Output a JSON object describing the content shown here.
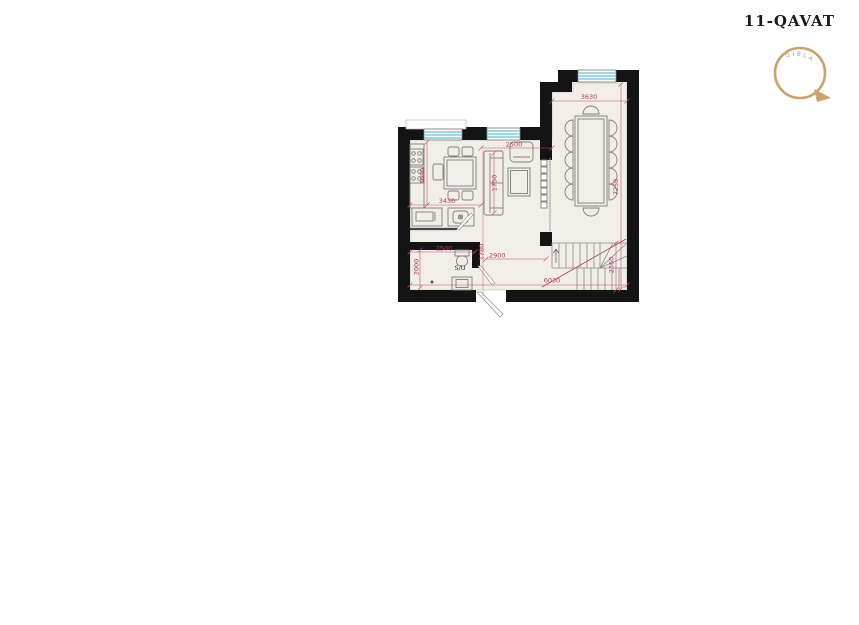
{
  "page": {
    "title": "11-QAVAT"
  },
  "compass": {
    "label": "QIBLA"
  },
  "plan": {
    "rooms": {
      "bathroom_label": "S/U"
    },
    "dimensions": {
      "conference_width": "3630",
      "conference_height": "7250",
      "living_width": "2500",
      "sofa_length": "1750",
      "kitchen_height": "3050",
      "kitchen_width": "3430",
      "su_width": "2500",
      "su_height": "2000",
      "hall_height": "1780",
      "hall_width": "2900",
      "bottom_width": "6030",
      "stairs_height": "2360"
    },
    "colors": {
      "wall": "#141414",
      "floor": "#f1eee8",
      "window_stripe": "#7ec8e3",
      "dimension": "#b83a52",
      "furniture": "#7d7d7d",
      "compass_ring": "#cfa06a"
    }
  }
}
